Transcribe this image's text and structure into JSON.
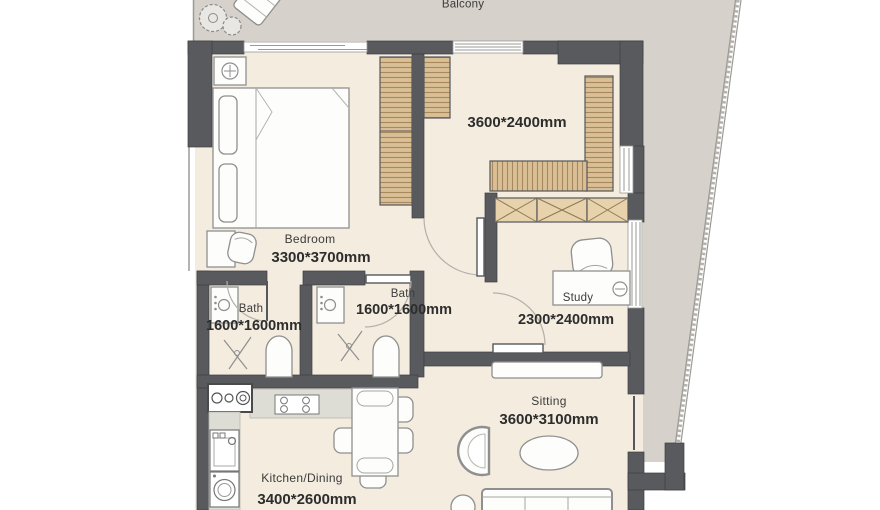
{
  "plan": {
    "balcony": {
      "name": "Balcony"
    },
    "dressing": {
      "dim": "3600*2400mm"
    },
    "bedroom": {
      "name": "Bedroom",
      "dim": "3300*3700mm"
    },
    "bath_ensuite": {
      "name": "Bath",
      "dim": "1600*1600mm"
    },
    "bath_hall": {
      "name": "Bath",
      "dim": "1600*1600mm"
    },
    "study": {
      "name": "Study",
      "dim": "2300*2400mm"
    },
    "sitting": {
      "name": "Sitting",
      "dim": "3600*3100mm"
    },
    "kitchen_dining": {
      "name": "Kitchen/Dining",
      "dim": "3400*2600mm"
    }
  },
  "palette": {
    "wall": "#595a5e",
    "interior_floor": "#f3ecdf",
    "balcony_floor": "#d6d1ca",
    "wardrobe": "#d9be96",
    "shelf": "#e7d2ac",
    "counter": "#dddcd5",
    "label_text": "#2d2d2d"
  }
}
